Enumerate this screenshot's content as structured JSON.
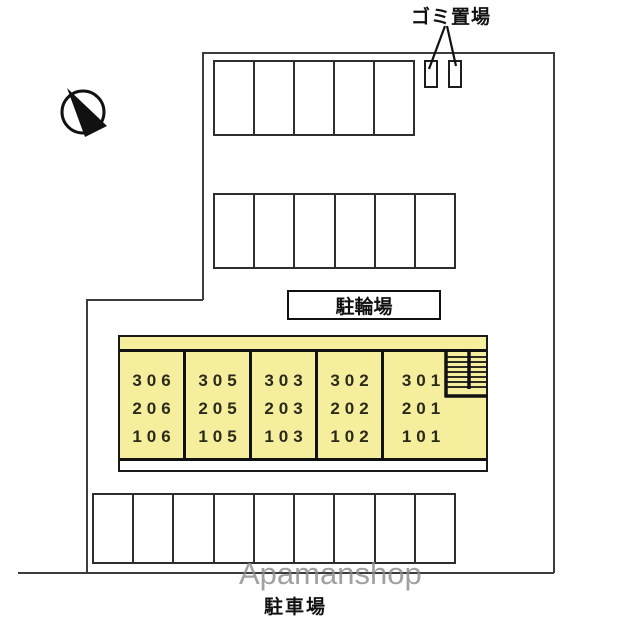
{
  "labels": {
    "garbage_area": "ゴミ置場",
    "bicycle_parking": "駐輪場",
    "car_parking": "駐車場",
    "watermark": "Apamanshop"
  },
  "building": {
    "fill_color": "#f5ee9d",
    "wall_color": "#111111",
    "units": [
      {
        "rooms": [
          "306",
          "206",
          "106"
        ]
      },
      {
        "rooms": [
          "305",
          "205",
          "105"
        ]
      },
      {
        "rooms": [
          "303",
          "203",
          "103"
        ]
      },
      {
        "rooms": [
          "302",
          "202",
          "102"
        ]
      },
      {
        "rooms": [
          "301",
          "201",
          "101"
        ]
      }
    ],
    "stairs": "switchback-staircase-top-right"
  },
  "site": {
    "boundary_color": "#3c3c3c",
    "compass": "north-arrow-pointing-upper-left",
    "garbage_bins_count": 2,
    "parking_rows": [
      {
        "position": "top",
        "stalls": 5
      },
      {
        "position": "middle",
        "stalls": 6
      },
      {
        "position": "bottom",
        "stalls": 9
      }
    ]
  }
}
